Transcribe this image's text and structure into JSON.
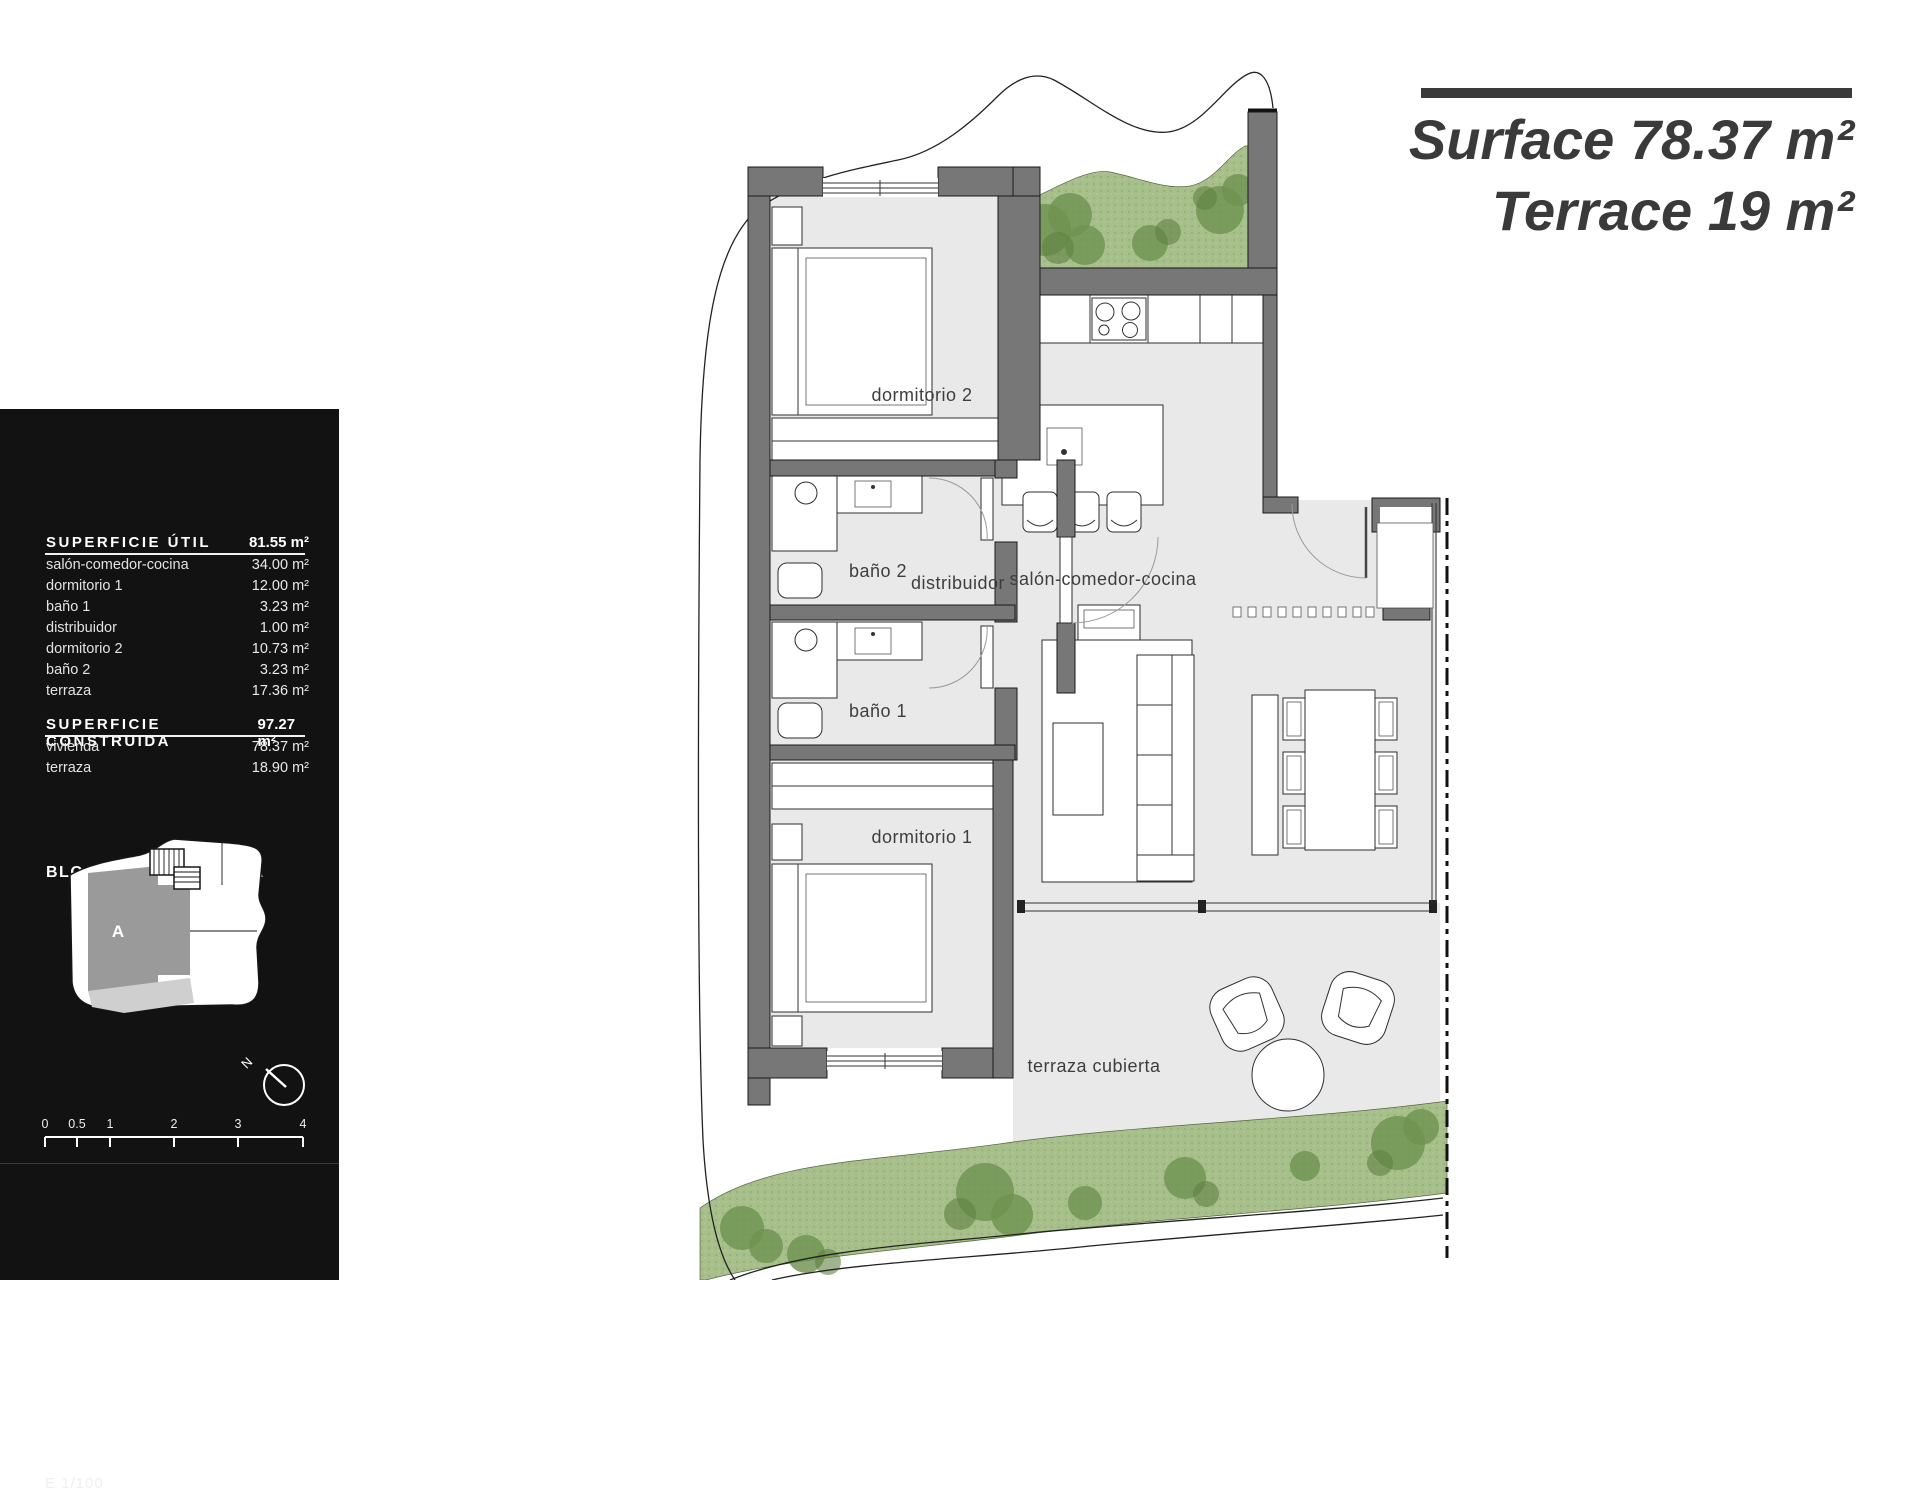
{
  "header": {
    "surface_label": "Surface",
    "surface_value": "78.37 m²",
    "terrace_label": "Terrace",
    "terrace_value": "19 m²"
  },
  "panel": {
    "block_title": "BLOQUE 1",
    "block_subtitle": "PLANTA BAJA",
    "util": {
      "heading": "SUPERFICIE ÚTIL",
      "total": "81.55 m²",
      "rows": [
        {
          "label": "salón-comedor-cocina",
          "value": "34.00 m²"
        },
        {
          "label": "dormitorio 1",
          "value": "12.00 m²"
        },
        {
          "label": "baño 1",
          "value": "3.23 m²"
        },
        {
          "label": "distribuidor",
          "value": "1.00 m²"
        },
        {
          "label": "dormitorio 2",
          "value": "10.73 m²"
        },
        {
          "label": "baño 2",
          "value": "3.23 m²"
        },
        {
          "label": "terraza",
          "value": "17.36 m²"
        }
      ]
    },
    "construida": {
      "heading": "SUPERFICIE CONSTRUIDA",
      "total": "97.27 m²",
      "rows": [
        {
          "label": "vivienda",
          "value": "78.37 m²"
        },
        {
          "label": "terraza",
          "value": "18.90 m²"
        }
      ]
    },
    "key_plan_label": "A",
    "scale_label": "E 1/100",
    "compass_label": "N",
    "scale_ticks": [
      "0",
      "0.5",
      "1",
      "2",
      "3",
      "4"
    ]
  },
  "plan": {
    "rooms": [
      "dormitorio 2",
      "baño 2",
      "distribuidor",
      "salón-comedor-cocina",
      "baño 1",
      "dormitorio 1",
      "terraza cubierta"
    ]
  },
  "colors": {
    "wall": "#777777",
    "floor": "#e9e9e9",
    "green": "#a7bf8b",
    "green_dark": "#6f9351",
    "panel_bg": "#121212",
    "accent": "#3a3a3a"
  }
}
